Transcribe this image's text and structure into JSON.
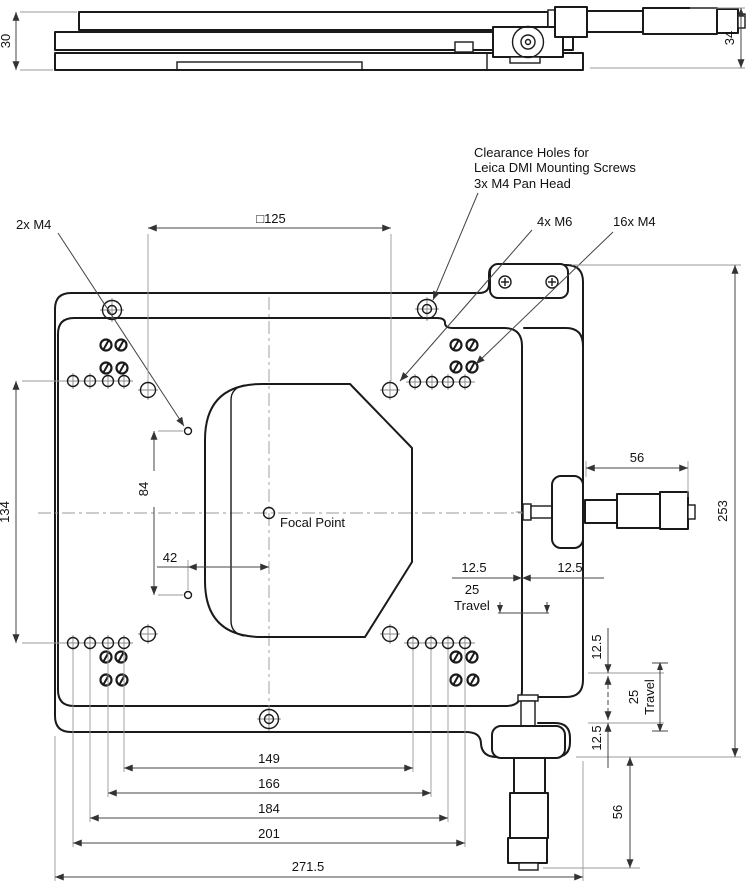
{
  "drawing": {
    "side_view": {
      "height_left": "30",
      "height_right": "34"
    },
    "labels": {
      "m4_2x": "2x M4",
      "clearance_line1": "Clearance Holes for",
      "clearance_line2": "Leica DMI Mounting Screws",
      "clearance_line3": "3x M4 Pan Head",
      "m6_4x": "4x M6",
      "m4_16x": "16x M4",
      "focal_point": "Focal Point"
    },
    "dimensions": {
      "square_125": "□125",
      "left_height_134": "134",
      "hole_spacing_84": "84",
      "offset_42": "42",
      "span_149": "149",
      "span_166": "166",
      "span_184": "184",
      "span_201": "201",
      "overall_width_271_5": "271.5",
      "overall_height_253": "253",
      "micrometer_56": "56",
      "half_travel_12_5": "12.5",
      "travel_25": "25",
      "travel_word": "Travel"
    }
  }
}
